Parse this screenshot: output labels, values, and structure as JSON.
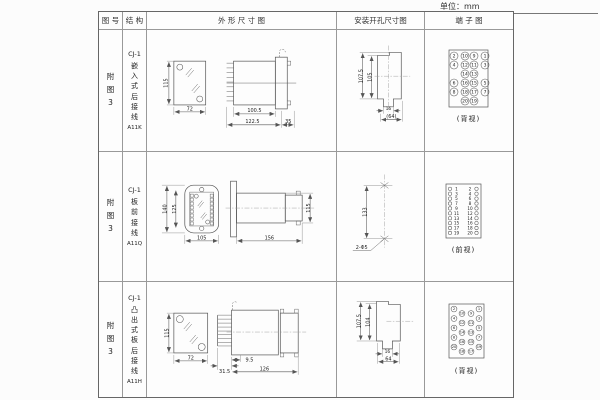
{
  "unit_label": "单位：mm",
  "headers": {
    "fig": "图 号",
    "struct": "结 构",
    "outline": "外 形 尺 寸 图",
    "mounting": "安装开孔尺寸图",
    "terminal": "端 子 图"
  },
  "rows": [
    {
      "fig_no": "附图3",
      "structure": {
        "model": "CJ-1",
        "type": "嵌入式后接线",
        "code": "A11K"
      },
      "outline": {
        "h": "115",
        "w": "72",
        "d1": "100.5",
        "d2": "122.5",
        "d3": "35"
      },
      "mounting": {
        "v1": "107.5",
        "v2": "105",
        "s": "16",
        "w": "(64)"
      },
      "terminal": {
        "view": "(背视)",
        "matrix": [
          [
            "2",
            "10",
            "9",
            "1"
          ],
          [
            "4",
            "12",
            "11",
            "3"
          ],
          [
            "14",
            "13"
          ],
          [
            "6",
            "16",
            "15",
            "5"
          ],
          [
            "8",
            "18",
            "17",
            "7"
          ],
          [
            "20",
            "19"
          ]
        ]
      }
    },
    {
      "fig_no": "附图3",
      "structure": {
        "model": "CJ-1",
        "type": "板前接线",
        "code": "A11Q"
      },
      "outline": {
        "h1": "140",
        "h2": "125",
        "w": "105",
        "l": "156",
        "sh": "115"
      },
      "mounting": {
        "v": "133",
        "hole": "2-Φ5"
      },
      "terminal": {
        "view": "(前视)",
        "pairs": [
          [
            "1",
            "2"
          ],
          [
            "3",
            "4"
          ],
          [
            "5",
            "6"
          ],
          [
            "7",
            "8"
          ],
          [
            "9",
            "10"
          ],
          [
            "11",
            "12"
          ],
          [
            "13",
            "14"
          ],
          [
            "15",
            "16"
          ],
          [
            "17",
            "18"
          ],
          [
            "19",
            "20"
          ]
        ]
      }
    },
    {
      "fig_no": "附图3",
      "structure": {
        "model": "CJ-1",
        "type": "凸出式板后接线",
        "code": "A11H"
      },
      "outline": {
        "h": "115",
        "w": "72",
        "d1": "31.5",
        "d2": "9.5",
        "d3": "126"
      },
      "mounting": {
        "v1": "107.5",
        "v2": "104",
        "s": "16",
        "w": "64"
      },
      "terminal": {
        "view": "(背视)",
        "ol": [
          "2",
          "4",
          "6",
          "8",
          "20"
        ],
        "il": [
          "10",
          "12",
          "14",
          "16",
          "18"
        ],
        "ir": [
          "9",
          "11",
          "13",
          "15",
          "17"
        ],
        "or": [
          "1",
          "3",
          "5",
          "7",
          "19"
        ]
      }
    }
  ]
}
